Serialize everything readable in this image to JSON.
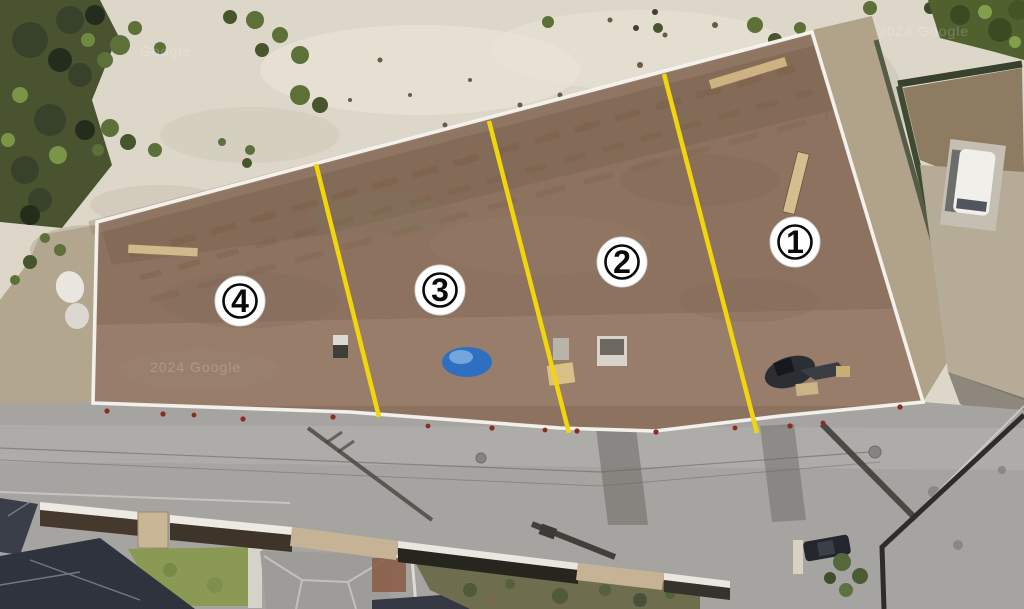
{
  "scene": {
    "description": "Aerial photo of a cleared land parcel subdivided into four numbered lots separated by yellow divider lines, bordered by a road and houses below",
    "lots": [
      {
        "label": "1"
      },
      {
        "label": "2"
      },
      {
        "label": "3"
      },
      {
        "label": "4"
      }
    ],
    "watermarks": {
      "top_left": "Google",
      "center": "2024 Google",
      "top_right": "2024 Google"
    },
    "colors": {
      "lot_divider": "#f2d60c",
      "parcel_boundary": "#f7f6f1",
      "marker_background": "#ffffff",
      "marker_ring": "#0a0a0a",
      "marker_number": "#0a0a0a",
      "tarp_blue": "#2f6fc2"
    }
  }
}
